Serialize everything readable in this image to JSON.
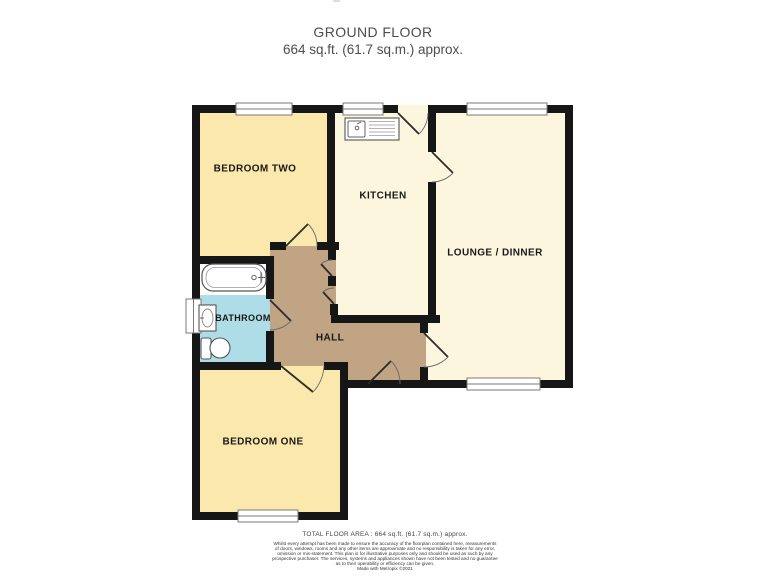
{
  "header": {
    "title": "GROUND FLOOR",
    "subtitle": "664 sq.ft. (61.7 sq.m.) approx."
  },
  "rooms": {
    "bedroom_two": {
      "label": "BEDROOM TWO"
    },
    "kitchen": {
      "label": "KITCHEN"
    },
    "lounge": {
      "label": "LOUNGE / DINNER"
    },
    "bathroom": {
      "label": "BATHROOM"
    },
    "hall": {
      "label": "HALL"
    },
    "bedroom_one": {
      "label": "BEDROOM ONE"
    }
  },
  "fixtures": [
    "bathtub",
    "basin",
    "toilet",
    "kitchen-sink"
  ],
  "colors": {
    "bedroom_floor": "#FBE8AC",
    "living_floor": "#FDF6DF",
    "hall_floor": "#C0A483",
    "bathroom_floor": "#AEDCE7",
    "wall": "#161616",
    "window_white": "#FFFFFF",
    "title_text": "#4d4d4d"
  },
  "footer": {
    "total_area": "TOTAL FLOOR AREA : 664 sq.ft. (61.7 sq.m.) approx.",
    "disclaimer_lines": [
      "Whilst every attempt has been made to ensure the accuracy of the floorplan contained here, measurements",
      "of doors, windows, rooms and any other items are approximate and no responsibility is taken for any error,",
      "omission or mis-statement. This plan is for illustrative purposes only and should be used as such by any",
      "prospective purchaser. The services, systems and appliances shown have not been tested and no guarantee",
      "as to their operability or efficiency can be given."
    ],
    "credit": "Made with Metropix ©2021"
  }
}
